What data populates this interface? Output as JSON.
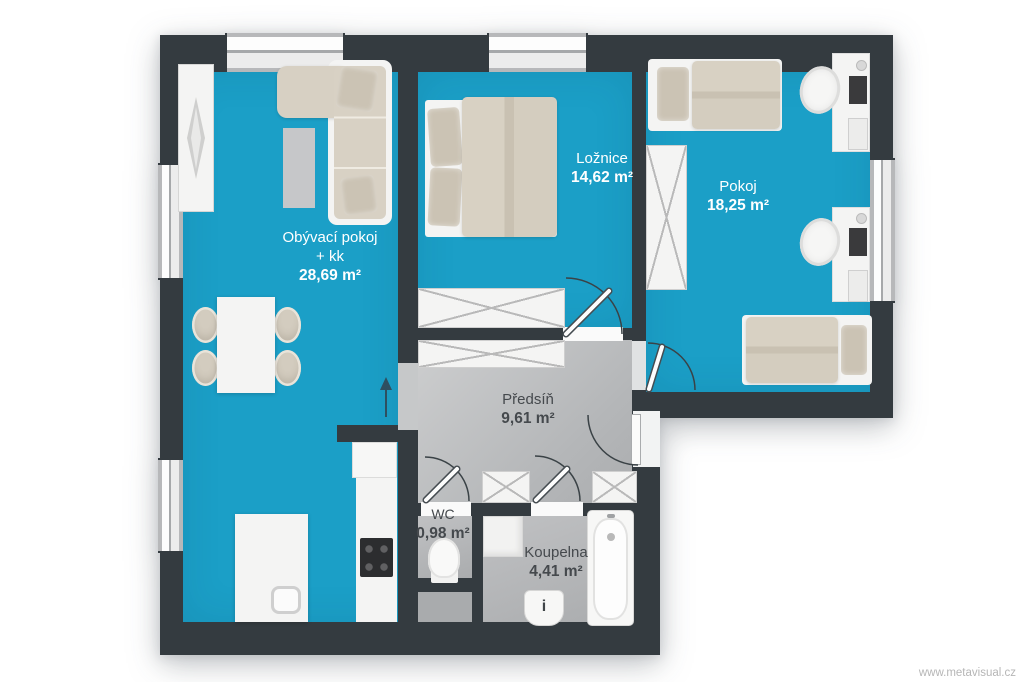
{
  "watermark": "www.metavisual.cz",
  "rooms": [
    {
      "name": "Obývací pokoj",
      "name_suffix": "+ kk",
      "area": "28,69 m²"
    },
    {
      "name": "Ložnice",
      "area": "14,62 m²"
    },
    {
      "name": "Pokoj",
      "area": "18,25 m²"
    },
    {
      "name": "Předsíň",
      "area": "9,61 m²"
    },
    {
      "name": "WC",
      "area": "0,98 m²"
    },
    {
      "name": "Koupelna",
      "area": "4,41 m²"
    }
  ],
  "fixtures": {
    "sink_mark": "i"
  },
  "colors": {
    "floor_teal": "#1b9fc7",
    "wall_dark": "#343b40",
    "hallway_gray": "#bcbec0",
    "furniture_beige": "#d7d0c3",
    "furniture_white": "#f4f4f3",
    "label_on_floor": "#ffffff",
    "label_on_gray": "#45494d"
  }
}
